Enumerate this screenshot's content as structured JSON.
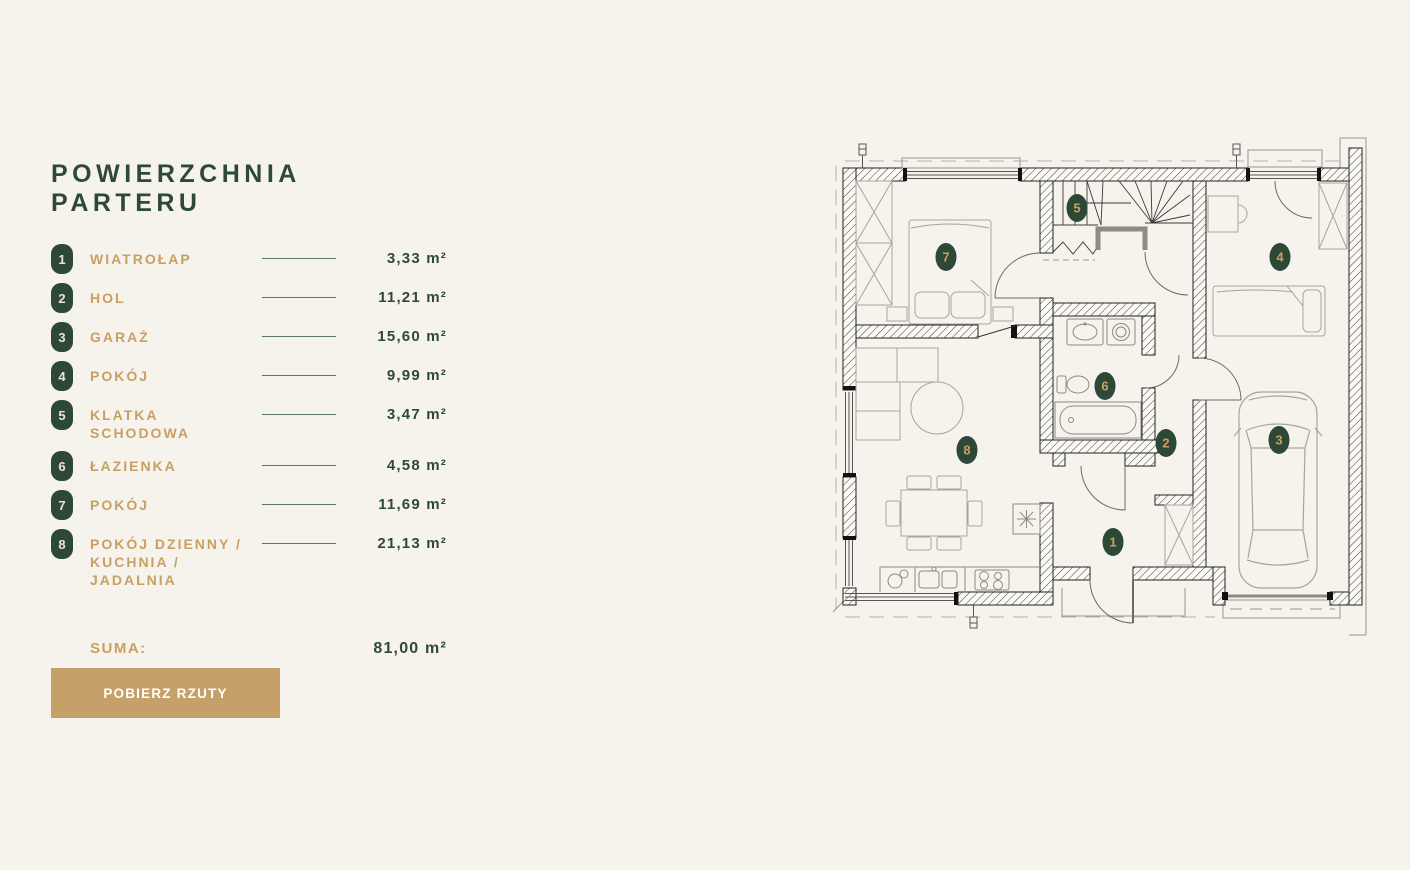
{
  "colors": {
    "background": "#f6f2ec",
    "accent_green": "#2e4937",
    "badge_green": "#2d4836",
    "accent_tan": "#c9a063",
    "button_tan": "#c5a068",
    "button_text": "#ffffff"
  },
  "legend": {
    "title": "POWIERZCHNIA PARTERU",
    "items": [
      {
        "num": "1",
        "label": "WIATROŁAP",
        "area": "3,33 m²"
      },
      {
        "num": "2",
        "label": "HOL",
        "area": "11,21 m²"
      },
      {
        "num": "3",
        "label": "GARAŻ",
        "area": "15,60 m²"
      },
      {
        "num": "4",
        "label": "POKÓJ",
        "area": "9,99 m²"
      },
      {
        "num": "5",
        "label": "KLATKA SCHODOWA",
        "area": "3,47 m²"
      },
      {
        "num": "6",
        "label": "ŁAZIENKA",
        "area": "4,58 m²"
      },
      {
        "num": "7",
        "label": "POKÓJ",
        "area": "11,69 m²"
      },
      {
        "num": "8",
        "label": "POKÓJ DZIENNY / KUCHNIA / JADALNIA",
        "area": "21,13 m²"
      }
    ],
    "suma_label": "SUMA:",
    "suma_value": "81,00 m²"
  },
  "button": {
    "label": "POBIERZ RZUTY"
  }
}
